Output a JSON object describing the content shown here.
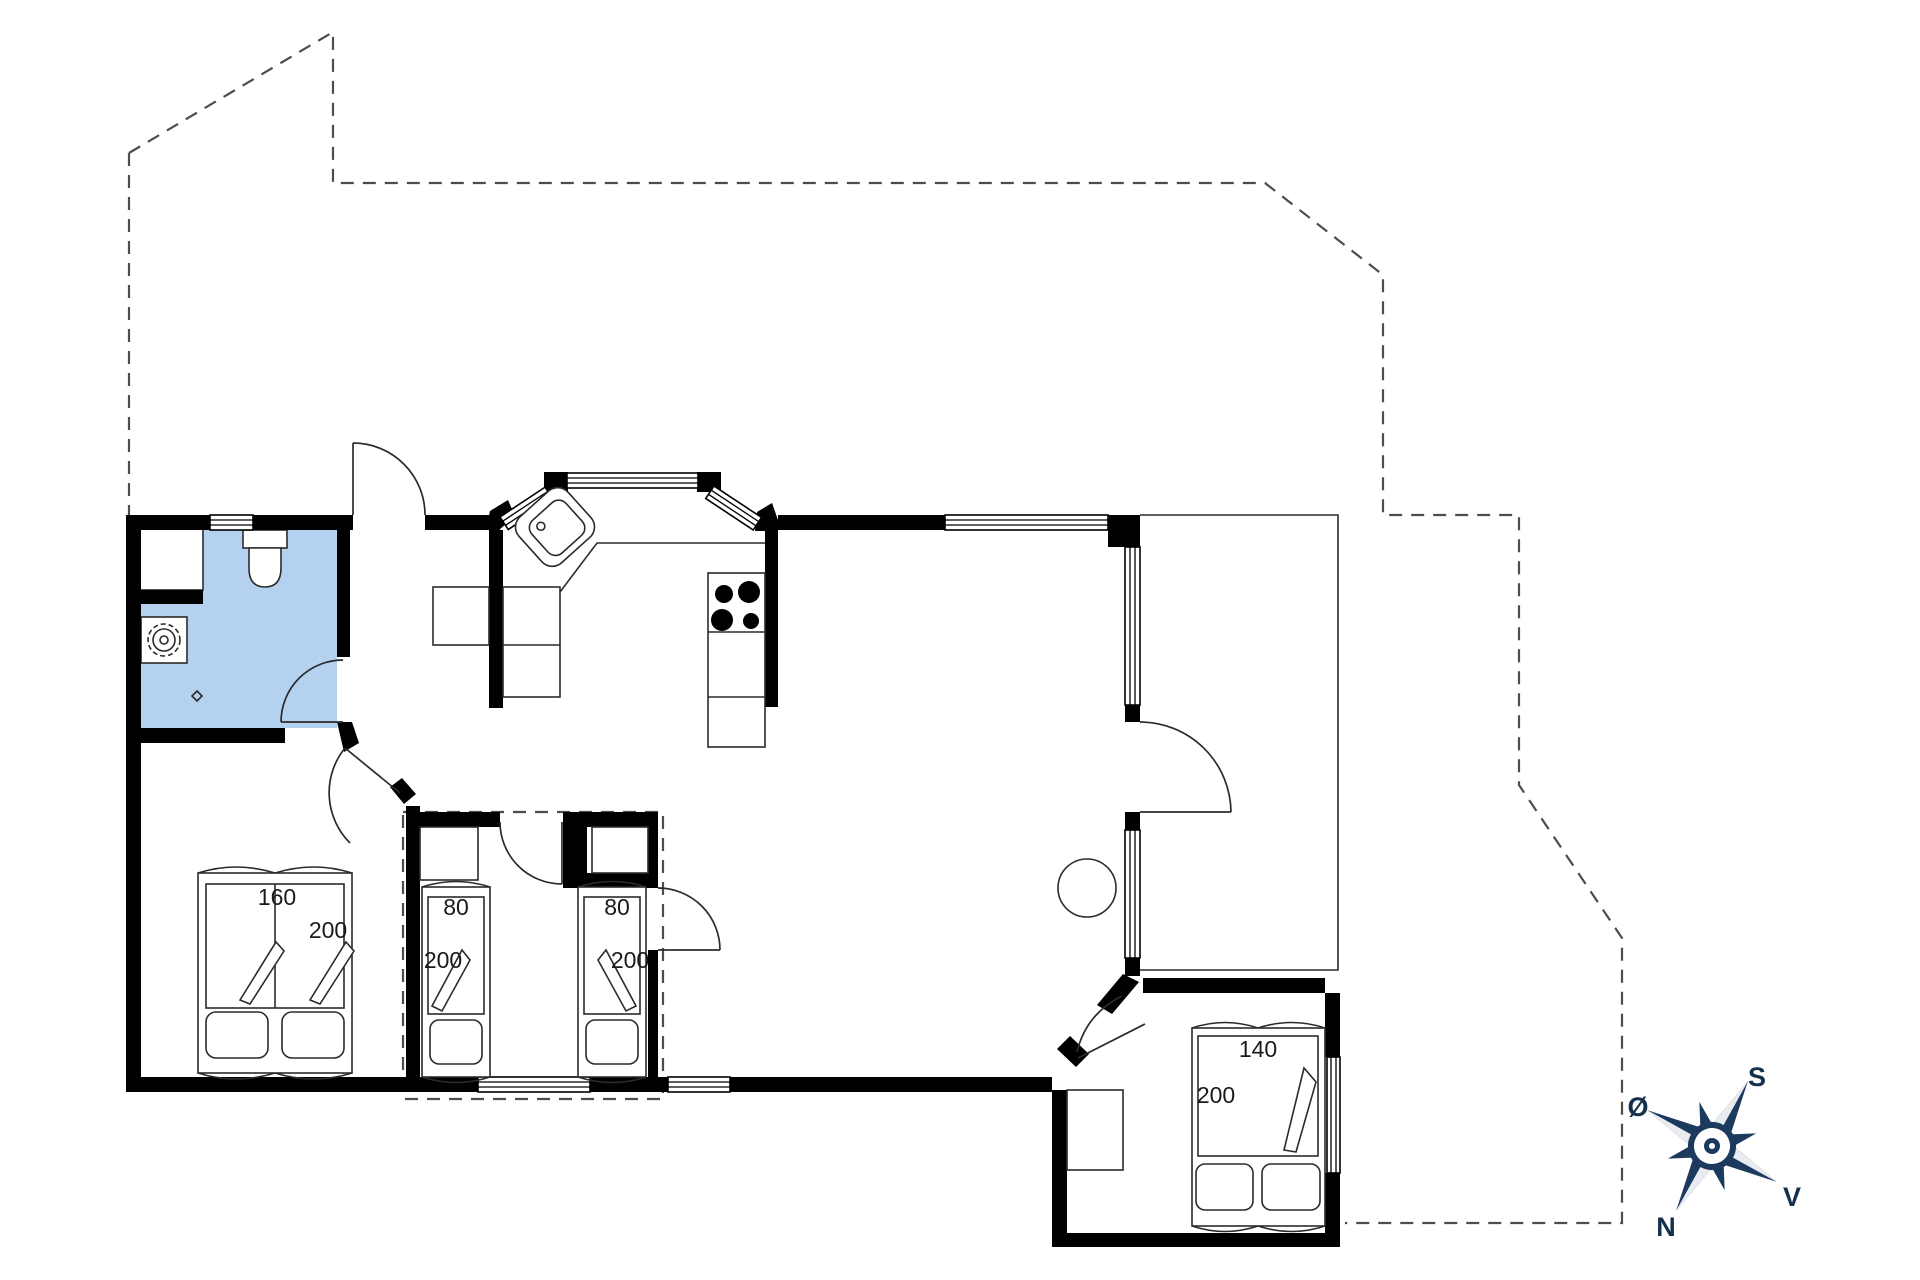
{
  "labels": {
    "bed1_width": "160",
    "bed1_length": "200",
    "bed2_width": "80",
    "bed2_length": "200",
    "bed3_width": "80",
    "bed3_length": "200",
    "bed4_width": "140",
    "bed4_length": "200"
  },
  "compass": {
    "south": "S",
    "east": "Ø",
    "west": "V",
    "north": "N"
  },
  "colors": {
    "bathroom_fill": "#b5d1f0",
    "compass_navy": "#1c3a5e",
    "wall_black": "#000000"
  }
}
